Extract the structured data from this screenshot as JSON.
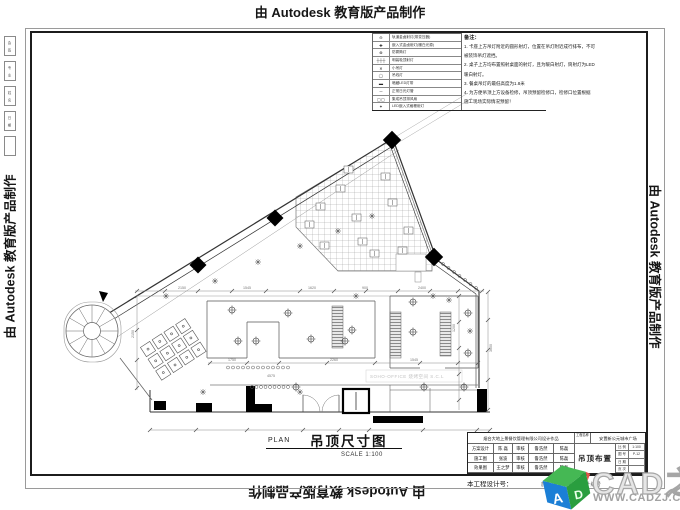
{
  "banners": {
    "top": "由 Autodesk 教育版产品制作",
    "bottom": "由 Autodesk 教育版产品制作",
    "left": "由 Autodesk 教育版产品制作",
    "right": "由 Autodesk 教育版产品制作"
  },
  "signature_strip": [
    "会 签",
    "专 业",
    "姓 名",
    "日 期",
    ""
  ],
  "legend": {
    "rows": [
      {
        "symbol": "⊖",
        "label": "轨道金卤射灯(带变压器)"
      },
      {
        "symbol": "✚",
        "label": "嵌入式金卤射灯(暖白光源)"
      },
      {
        "symbol": "⊗",
        "label": "防雾筒灯"
      },
      {
        "symbol": "┼┼┼",
        "label": "明装吸顶射灯"
      },
      {
        "symbol": "✕",
        "label": "小吊灯"
      },
      {
        "symbol": "◯",
        "label": "吊线灯"
      },
      {
        "symbol": "▬",
        "label": "暗藏LED灯带"
      },
      {
        "symbol": "─",
        "label": "正常日光灯管"
      },
      {
        "symbol": "▢▢",
        "label": "集成吊顶排风扇"
      },
      {
        "symbol": "✦",
        "label": "LED嵌入式格栅射灯"
      }
    ]
  },
  "notes": {
    "title": "备注：",
    "lines": [
      "1. 卡座上方吊灯附近的圆形射灯，位置在吊灯附近成行排布，不可",
      "被装饰吊灯遮挡。",
      "2. 桌子上方均布置照射桌面的射灯，且为暖白射灯，筒射灯为LED",
      "暖白射灯。",
      "3. 餐桌吊灯的最低高度为1.8米",
      "4. 为方便吊顶上方设备检修，吊顶预留检修口，检修口位置根据",
      "施工现场实际情况预留！"
    ]
  },
  "plan_caption": {
    "plan": "PLAN",
    "title": "吊顶尺寸图",
    "scale": "SCALE 1:100"
  },
  "title_block": {
    "company": "烟台大地上景餐饮管理有限公司设计作品",
    "rows": [
      {
        "label": "方案设计",
        "name": "陈 磊",
        "check": "审核",
        "checker": "鲁浩然",
        "approver": "陈磊"
      },
      {
        "label": "施工图",
        "name": "张波",
        "check": "审核",
        "checker": "鲁浩然",
        "approver": "陈磊"
      },
      {
        "label": "效果图",
        "name": "王之梦",
        "check": "审核",
        "checker": "鲁浩然",
        "approver": "陈磊"
      }
    ],
    "project_label": "工程名称",
    "project": "安置新公元城市广场",
    "drawing_name": "吊顶布置图",
    "meta": [
      {
        "k": "比 例",
        "v": "1:100"
      },
      {
        "k": "图 号",
        "v": "P-12"
      },
      {
        "k": "日 期",
        "v": ""
      },
      {
        "k": "页 次",
        "v": ""
      }
    ],
    "design_no_label": "本工程设计号：",
    "approval_note": "施工图审核批准设计编号"
  },
  "watermark": {
    "brand": "CAD之家",
    "url": "WWW.CADZJ.COM",
    "logo_colors": {
      "top": "#45b854",
      "left": "#1b7fd6",
      "right": "#2a9e3f",
      "accent": "#e2574c"
    },
    "logo_letter": "A"
  },
  "drawing": {
    "inner_watermark": "SOHO-OFFICE 烧烤空间 S.C.L",
    "dim_labels": [
      {
        "x": 178,
        "y": 289,
        "t": "2150"
      },
      {
        "x": 243,
        "y": 289,
        "t": "1545"
      },
      {
        "x": 308,
        "y": 289,
        "t": "1620"
      },
      {
        "x": 362,
        "y": 289,
        "t": "900"
      },
      {
        "x": 418,
        "y": 289,
        "t": "2400"
      },
      {
        "x": 267,
        "y": 377,
        "t": "4575"
      },
      {
        "x": 228,
        "y": 361,
        "t": "1750"
      },
      {
        "x": 330,
        "y": 361,
        "t": "2260"
      },
      {
        "x": 410,
        "y": 361,
        "t": "1545"
      },
      {
        "x": 455,
        "y": 332,
        "t": "1200",
        "r": -90
      },
      {
        "x": 492,
        "y": 352,
        "t": "3600",
        "r": -90
      },
      {
        "x": 134,
        "y": 338,
        "t": "2150",
        "r": -90
      }
    ]
  }
}
